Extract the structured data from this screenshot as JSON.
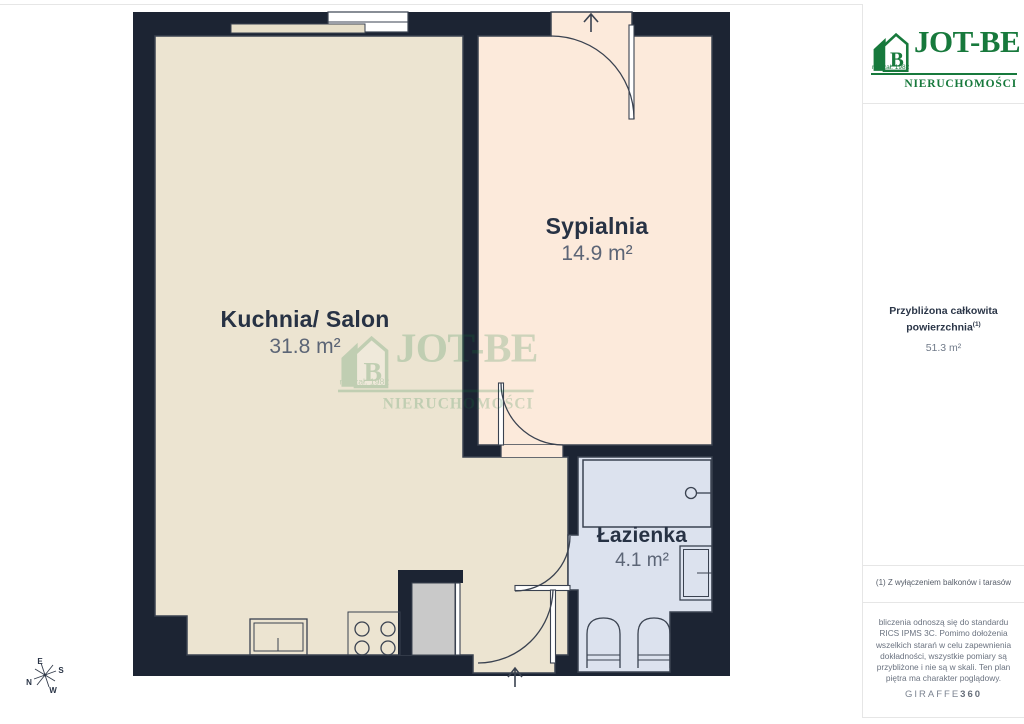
{
  "colors": {
    "wall": "#1c2433",
    "outline": "#3a4250",
    "floor-kitchen": "#ece4d1",
    "floor-bedroom": "#fceadb",
    "floor-bath": "#dce2ee",
    "fixture": "#c9c9c9",
    "counter": "#e7dfc9",
    "green": "#17793c",
    "ink": "#273244",
    "muted": "#6e7787",
    "line": "#e6e6e6"
  },
  "plan": {
    "rooms": [
      {
        "name": "Kuchnia/ Salon",
        "area": "31.8 m²"
      },
      {
        "name": "Sypialnia",
        "area": "14.9 m²"
      },
      {
        "name": "Łazienka",
        "area": "4.1 m²"
      }
    ],
    "compass": {
      "n": "N",
      "e": "E",
      "s": "S",
      "w": "W"
    }
  },
  "sidebar": {
    "logo": {
      "title": "JOT-BE",
      "subtitle": "NIERUCHOMOŚCI",
      "tagline": "rok zał. 1982",
      "icon_letter": "B"
    },
    "total": {
      "label": "Przybliżona całkowita powierzchnia",
      "sup": "(1)",
      "value": "51.3 m²"
    },
    "footnote": "(1) Z wyłączeniem balkonów i tarasów",
    "disclaimer": "bliczenia odnoszą się do standardu RICS IPMS 3C. Pomimo dołożenia wszelkich starań w celu zapewnienia dokładności, wszystkie pomiary są przybliżone i nie są w skali. Ten plan piętra ma charakter poglądowy.",
    "brand": {
      "name": "GIRAFFE",
      "suffix": "360"
    }
  }
}
